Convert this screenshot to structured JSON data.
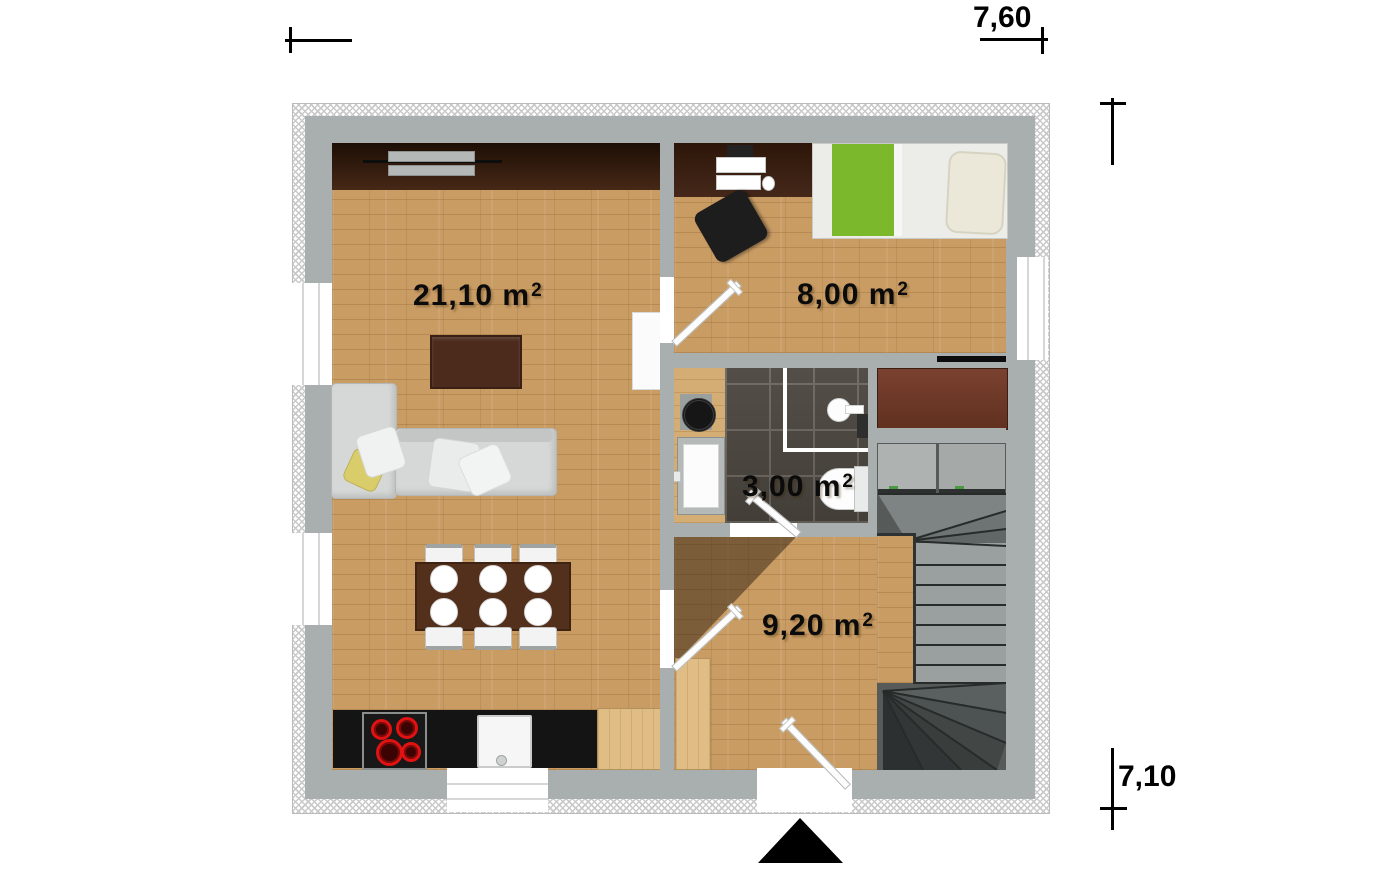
{
  "plan": {
    "dimension_width": "7,60",
    "dimension_height": "7,10",
    "area_unit": {
      "base": "m",
      "sup": "2"
    },
    "rooms": {
      "living_room": {
        "area": "21,10"
      },
      "bedroom": {
        "area": "8,00"
      },
      "bathroom": {
        "area": "3,00"
      },
      "hallway": {
        "area": "9,20"
      }
    },
    "colors": {
      "wall": "#a9aeae",
      "insulation_hatch": "#c9c9c9",
      "wood_floor": "#c99c64",
      "dark_wood_desk": "#3a2114",
      "sideboard": "#2f1a0e",
      "dining_table": "#53301c",
      "wardrobe": "#6f3a28",
      "stairs": "#565b5a",
      "bathroom_tile": "#4a453e",
      "kitchen_counter": "#141414",
      "sofa": "#d6d8d7",
      "bed_blanket_green": "#7cb82c",
      "pillow_yellow": "#d9cd6b",
      "burner_red": "#e01212",
      "label_text": "#0b0b0b"
    }
  }
}
